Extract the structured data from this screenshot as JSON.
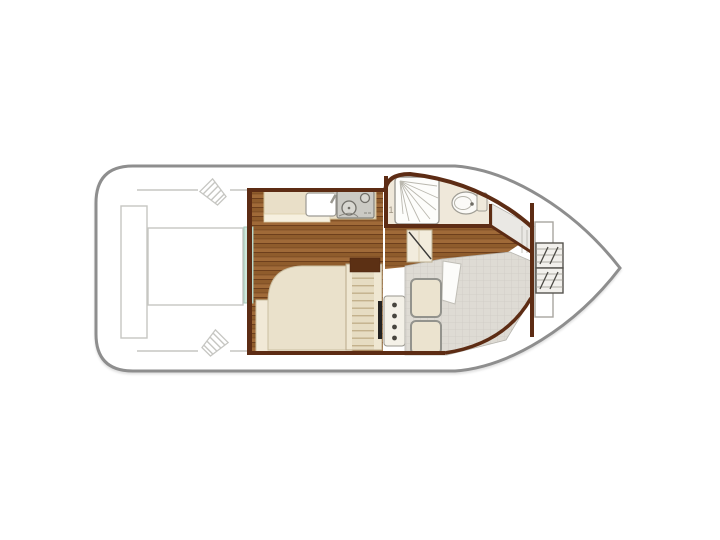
{
  "plan": {
    "type": "boat-floor-plan",
    "shower_label": "1",
    "fixtures": [
      "stern-deck",
      "stern-bench",
      "stern-sunpad",
      "mooring-cleats",
      "saloon-wood-floor",
      "entry-door",
      "galley-counter",
      "galley-sink",
      "two-burner-stove",
      "saloon-berth",
      "companionway-steps",
      "step-locker",
      "helm-console",
      "bathroom",
      "shower",
      "toilet",
      "bathroom-door",
      "cockpit-deck",
      "cockpit-seats",
      "seat-backrest",
      "side-deck",
      "windshield-bulkhead",
      "bow-locker",
      "bow-steps"
    ]
  },
  "colors": {
    "hull_outline": "#8e8e8e",
    "cabin_wall": "#5d2c14",
    "wood_base": "#8f5c2c",
    "wood_light": "#a06a38",
    "wood_dark": "#6d3f1c",
    "floor_cream": "#efe8da",
    "counter": "#e9dfc8",
    "teal_door": "#cfe8dc",
    "teal_door_border": "#a5c9b9",
    "deck_grid": "#dedbd4",
    "deck_grid_line": "#cecbc4",
    "seat_cushion": "#ebe3cf",
    "seat_border": "#93938d",
    "steps_base": "#e6dcc2",
    "steps_line": "#c3b18c",
    "outline_light": "#c6c6c2",
    "fixture_outline": "#9c9a94",
    "stove_gray": "#cbcac4",
    "console_black": "#222222",
    "bed_base": "#f1e9d7",
    "bed_mattress": "#eae1cb",
    "bed_border": "#cbbfa2",
    "side_deck_gray": "#eae8e4",
    "door_diag": "#3a3a38",
    "label_gray": "#9b9180"
  }
}
